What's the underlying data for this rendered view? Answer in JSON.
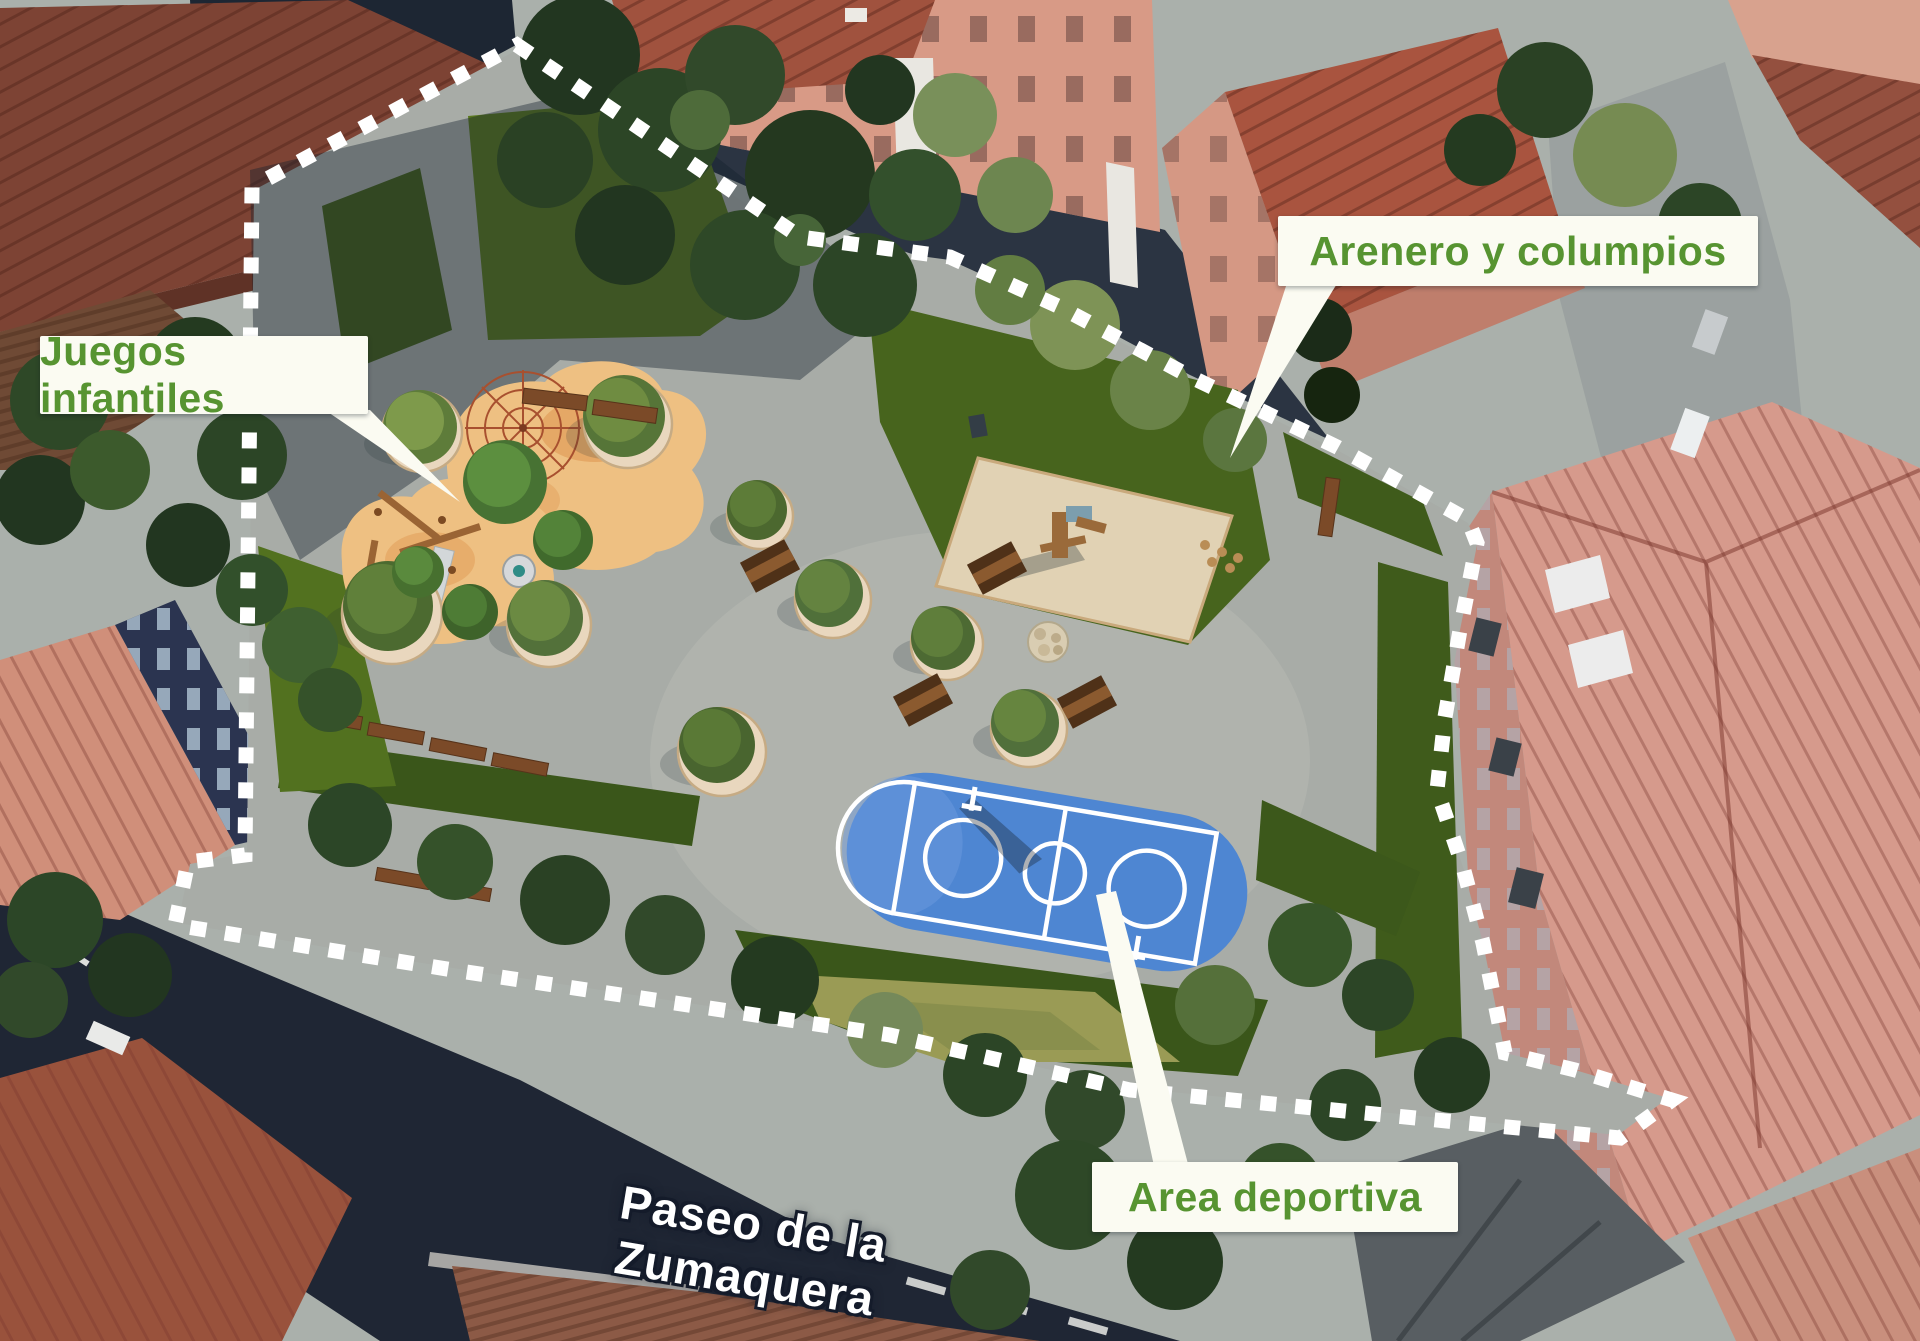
{
  "annotations": {
    "juegos_infantiles": {
      "text": "Juegos infantiles"
    },
    "arenero_columpios": {
      "text": "Arenero y columpios"
    },
    "area_deportiva": {
      "text": "Area deportiva"
    }
  },
  "street": {
    "name": "Paseo de la Zumaquera"
  },
  "colors": {
    "label-green": "#579431",
    "label-bg": "#fbfbf2",
    "boundary-white": "#ffffff",
    "court-blue": "#4e86d2",
    "sand-orange": "#eec082",
    "planter-sand": "#e9d7be",
    "paving-gray": "#a8aca7",
    "lawn-green": "#5a781e",
    "hedge-green": "#3c581b",
    "street-dark": "#1f2634",
    "roof-terracotta": "#a0523e",
    "wall-salmon": "#d89a86"
  }
}
